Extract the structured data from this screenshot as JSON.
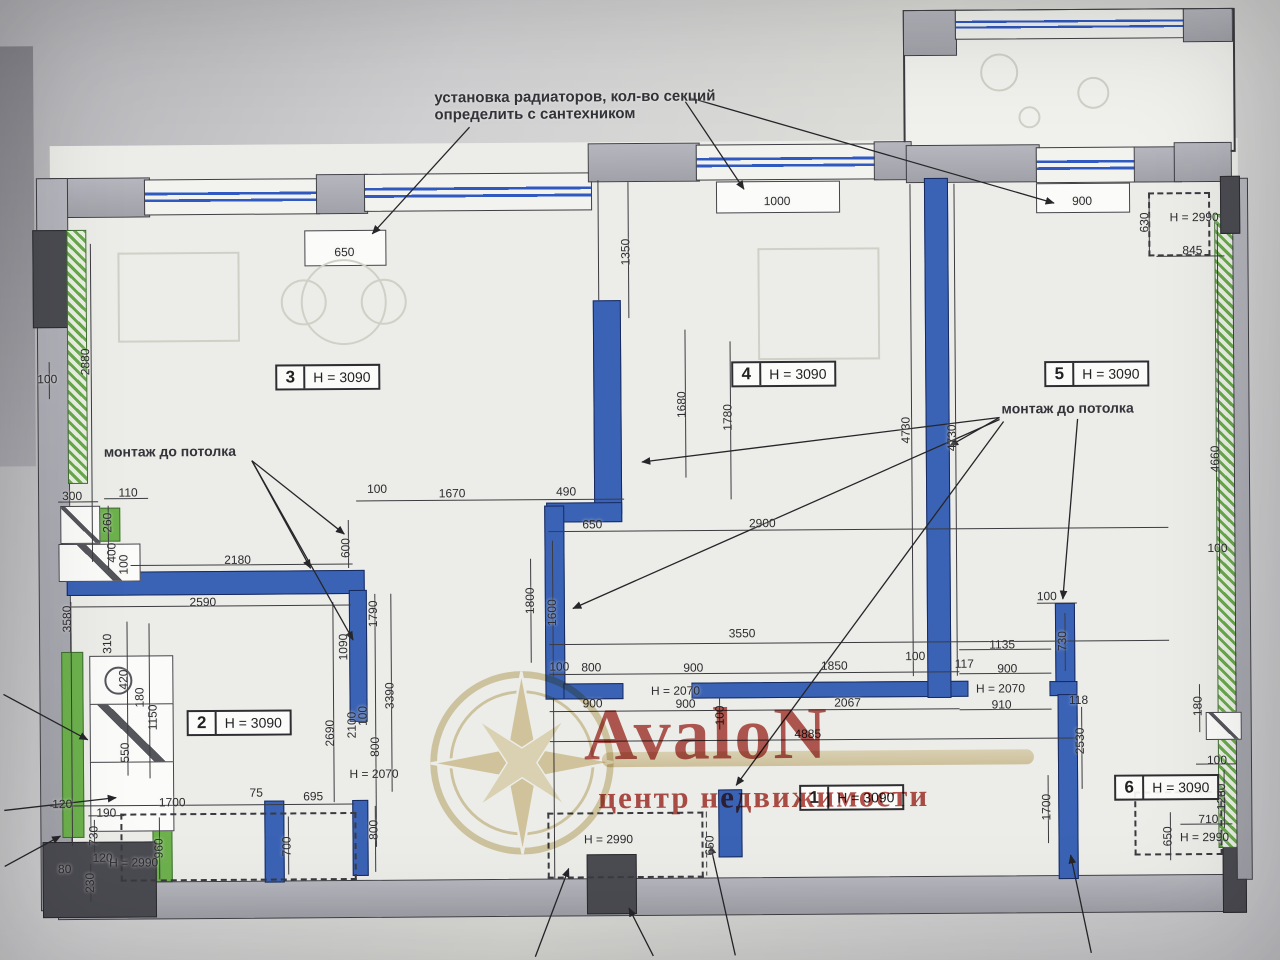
{
  "annotations": {
    "radiators_line1": "установка радиаторов, кол-во секций",
    "radiators_line2": "определить с сантехником",
    "ceiling_mount_left": "монтаж до потолка",
    "ceiling_mount_right": "монтаж до потолка"
  },
  "watermark": {
    "brand": "AvaloN",
    "subtitle": "центр недвижимости"
  },
  "colors": {
    "wall_blue": "#3b63b5",
    "wall_green": "#69a84c",
    "watermark_red": "#a8322c",
    "watermark_gold": "#c9ad63"
  },
  "rooms": [
    {
      "number": "3",
      "height": "H = 3090",
      "x": 276,
      "y": 362
    },
    {
      "number": "4",
      "height": "H = 3090",
      "x": 732,
      "y": 362
    },
    {
      "number": "5",
      "height": "H = 3090",
      "x": 1045,
      "y": 364
    },
    {
      "number": "2",
      "height": "H = 3090",
      "x": 185,
      "y": 707
    },
    {
      "number": "1",
      "height": "H = 3090",
      "x": 797,
      "y": 786
    },
    {
      "number": "6",
      "height": "H = 3090",
      "x": 1112,
      "y": 778
    }
  ],
  "dimensions": [
    {
      "t": "650",
      "x": 346,
      "y": 250
    },
    {
      "t": "1000",
      "x": 779,
      "y": 202
    },
    {
      "t": "900",
      "x": 1084,
      "y": 204
    },
    {
      "t": "630",
      "x": 1146,
      "y": 226,
      "v": 1
    },
    {
      "t": "H = 2990",
      "x": 1196,
      "y": 221
    },
    {
      "t": "845",
      "x": 1194,
      "y": 254
    },
    {
      "t": "1350",
      "x": 627,
      "y": 252,
      "v": 1
    },
    {
      "t": "100",
      "x": 48,
      "y": 375
    },
    {
      "t": "2880",
      "x": 86,
      "y": 358,
      "v": 1
    },
    {
      "t": "1680",
      "x": 682,
      "y": 405,
      "v": 1
    },
    {
      "t": "1780",
      "x": 728,
      "y": 418,
      "v": 1
    },
    {
      "t": "4730",
      "x": 906,
      "y": 432,
      "v": 1
    },
    {
      "t": "4730",
      "x": 952,
      "y": 440,
      "v": 1
    },
    {
      "t": "4660",
      "x": 1215,
      "y": 463,
      "v": 1
    },
    {
      "t": "100",
      "x": 1217,
      "y": 552
    },
    {
      "t": "110",
      "x": 128,
      "y": 489
    },
    {
      "t": "300",
      "x": 72,
      "y": 492
    },
    {
      "t": "260",
      "x": 107,
      "y": 519,
      "v": 1
    },
    {
      "t": "400",
      "x": 111,
      "y": 549,
      "v": 1
    },
    {
      "t": "100",
      "x": 123,
      "y": 561,
      "v": 1
    },
    {
      "t": "2180",
      "x": 237,
      "y": 557
    },
    {
      "t": "600",
      "x": 345,
      "y": 546,
      "v": 1
    },
    {
      "t": "100",
      "x": 377,
      "y": 487
    },
    {
      "t": "1670",
      "x": 452,
      "y": 492
    },
    {
      "t": "490",
      "x": 566,
      "y": 491
    },
    {
      "t": "650",
      "x": 592,
      "y": 524
    },
    {
      "t": "2900",
      "x": 762,
      "y": 524
    },
    {
      "t": "2590",
      "x": 202,
      "y": 599
    },
    {
      "t": "3580",
      "x": 66,
      "y": 615,
      "v": 1
    },
    {
      "t": "310",
      "x": 106,
      "y": 640,
      "v": 1
    },
    {
      "t": "420",
      "x": 122,
      "y": 676,
      "v": 1
    },
    {
      "t": "180",
      "x": 138,
      "y": 694,
      "v": 1
    },
    {
      "t": "1150",
      "x": 151,
      "y": 714,
      "v": 1
    },
    {
      "t": "550",
      "x": 123,
      "y": 749,
      "v": 1
    },
    {
      "t": "1090",
      "x": 342,
      "y": 645,
      "v": 1
    },
    {
      "t": "1790",
      "x": 372,
      "y": 612,
      "v": 1
    },
    {
      "t": "3390",
      "x": 388,
      "y": 694,
      "v": 1
    },
    {
      "t": "2690",
      "x": 328,
      "y": 731,
      "v": 1
    },
    {
      "t": "2100",
      "x": 350,
      "y": 723,
      "v": 1
    },
    {
      "t": "100",
      "x": 361,
      "y": 714,
      "v": 1
    },
    {
      "t": "800",
      "x": 373,
      "y": 745,
      "v": 1
    },
    {
      "t": "H = 2070",
      "x": 372,
      "y": 772
    },
    {
      "t": "800",
      "x": 371,
      "y": 828,
      "v": 1
    },
    {
      "t": "1800",
      "x": 529,
      "y": 600,
      "v": 1
    },
    {
      "t": "1600",
      "x": 551,
      "y": 612,
      "v": 1
    },
    {
      "t": "3550",
      "x": 741,
      "y": 634
    },
    {
      "t": "100",
      "x": 558,
      "y": 666
    },
    {
      "t": "800",
      "x": 590,
      "y": 667
    },
    {
      "t": "900",
      "x": 692,
      "y": 668
    },
    {
      "t": "1850",
      "x": 833,
      "y": 667
    },
    {
      "t": "100",
      "x": 914,
      "y": 658
    },
    {
      "t": "900",
      "x": 591,
      "y": 703
    },
    {
      "t": "900",
      "x": 684,
      "y": 704
    },
    {
      "t": "100",
      "x": 718,
      "y": 716,
      "v": 1
    },
    {
      "t": "2067",
      "x": 846,
      "y": 704
    },
    {
      "t": "4885",
      "x": 806,
      "y": 735
    },
    {
      "t": "H = 2070",
      "x": 674,
      "y": 691
    },
    {
      "t": "117",
      "x": 963,
      "y": 666
    },
    {
      "t": "1135",
      "x": 1001,
      "y": 647
    },
    {
      "t": "730",
      "x": 1061,
      "y": 644,
      "v": 1
    },
    {
      "t": "100",
      "x": 1046,
      "y": 599
    },
    {
      "t": "900",
      "x": 1006,
      "y": 671
    },
    {
      "t": "H = 2070",
      "x": 999,
      "y": 691
    },
    {
      "t": "910",
      "x": 1000,
      "y": 707
    },
    {
      "t": "118",
      "x": 1077,
      "y": 703
    },
    {
      "t": "180",
      "x": 1196,
      "y": 710,
      "v": 1
    },
    {
      "t": "2530",
      "x": 1078,
      "y": 744,
      "v": 1
    },
    {
      "t": "1700",
      "x": 1044,
      "y": 810,
      "v": 1
    },
    {
      "t": "100",
      "x": 1215,
      "y": 764
    },
    {
      "t": "1280",
      "x": 1219,
      "y": 801,
      "v": 1
    },
    {
      "t": "710",
      "x": 1206,
      "y": 823
    },
    {
      "t": "H = 2990",
      "x": 1202,
      "y": 841
    },
    {
      "t": "650",
      "x": 1165,
      "y": 840,
      "v": 1
    },
    {
      "t": "120",
      "x": 60,
      "y": 800
    },
    {
      "t": "1700",
      "x": 170,
      "y": 799
    },
    {
      "t": "75",
      "x": 254,
      "y": 790
    },
    {
      "t": "695",
      "x": 311,
      "y": 794
    },
    {
      "t": "190",
      "x": 104,
      "y": 809
    },
    {
      "t": "730",
      "x": 91,
      "y": 832,
      "v": 1
    },
    {
      "t": "120",
      "x": 100,
      "y": 854
    },
    {
      "t": "230",
      "x": 87,
      "y": 879,
      "v": 1
    },
    {
      "t": "960",
      "x": 156,
      "y": 845,
      "v": 1
    },
    {
      "t": "H = 2990",
      "x": 131,
      "y": 859
    },
    {
      "t": "80",
      "x": 62,
      "y": 865
    },
    {
      "t": "700",
      "x": 284,
      "y": 844,
      "v": 1
    },
    {
      "t": "H = 2990",
      "x": 606,
      "y": 839
    },
    {
      "t": "650",
      "x": 707,
      "y": 846,
      "v": 1
    }
  ]
}
